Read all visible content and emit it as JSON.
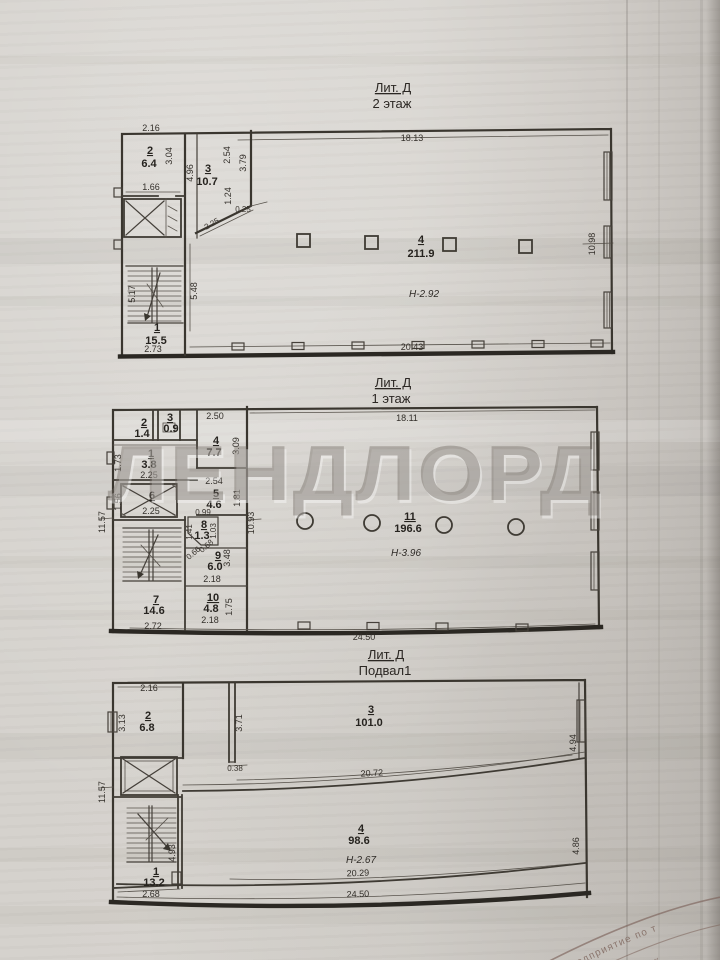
{
  "watermark": "ЛЕНДЛОРД",
  "floor2": {
    "title1": "Лит. Д",
    "title2": "2 этаж",
    "rooms": {
      "r1_num": "1",
      "r1_area": "15.5",
      "r2_num": "2",
      "r2_area": "6.4",
      "r3_num": "3",
      "r3_area": "10.7",
      "r4_num": "4",
      "r4_area": "211.9",
      "r4_height": "Н-2.92"
    },
    "dims": {
      "top": "18.13",
      "bottom": "20.43",
      "right_wall": "10.98",
      "r2_top": "2.16",
      "r2_side": "3.04",
      "r2_bottom": "1.66",
      "r3_side": "4.96",
      "r3_right": "2.54",
      "r3_far_right": "3.79",
      "r3_lower": "1.24",
      "wall_thick": "0.25",
      "diag": "2.25",
      "stairs_side": "5.17",
      "stairs_depth": "5.48",
      "r1_bottom": "2.73"
    }
  },
  "floor1": {
    "title1": "Лит. Д",
    "title2": "1 этаж",
    "rooms": {
      "r1_num": "1",
      "r1_area": "3.8",
      "r2_num": "2",
      "r2_area": "1.4",
      "r3_num": "3",
      "r3_area": "0.9",
      "r4_num": "4",
      "r4_area": "7.7",
      "r5_num": "5",
      "r5_area": "4.6",
      "r6_num": "6",
      "r7_num": "7",
      "r7_area": "14.6",
      "r8_num": "8",
      "r8_area": "1.3",
      "r9_num": "9",
      "r9_area": "6.0",
      "r10_num": "10",
      "r10_area": "4.8",
      "r11_num": "11",
      "r11_area": "196.6",
      "r11_height": "Н-3.96"
    },
    "dims": {
      "top": "18.11",
      "bottom": "24.50",
      "left_wall": "11.57",
      "hall_side": "10.93",
      "r4_top": "2.50",
      "r4_side": "3.09",
      "r1_side": "1.73",
      "r1_bottom": "2.25",
      "r5_top": "2.54",
      "r5_side": "1.81",
      "r6_side": "1.56",
      "r6_bottom": "2.25",
      "r8_top": "0.99",
      "r8_left": "1.41",
      "r8_right": "1.03",
      "r8_diag1": "0.66",
      "r8_diag2": "0.68",
      "r9_side": "3.48",
      "r9_bottom": "2.18",
      "r10_side": "1.75",
      "r10_bottom": "2.18",
      "r7_bottom": "2.72"
    }
  },
  "basement": {
    "title1": "Лит. Д",
    "title2": "Подвал1",
    "rooms": {
      "r1_num": "1",
      "r1_area": "13.2",
      "r2_num": "2",
      "r2_area": "6.8",
      "r3_num": "3",
      "r3_area": "101.0",
      "r4_num": "4",
      "r4_area": "98.6",
      "r4_height": "Н-2.67"
    },
    "dims": {
      "left_wall": "11.57",
      "r2_top": "2.16",
      "r2_side": "3.13",
      "partition": "3.71",
      "offset": "0.38",
      "r3_bottom": "20.72",
      "r3_side": "4.94",
      "r4_bottom": "20.29",
      "r4_side": "4.86",
      "bottom": "24.50",
      "r1_side": "4.93",
      "r1_bottom": "2.68"
    }
  },
  "stamp": {
    "arc_text1": "ное предприятие по т",
    "arc_text2": "оценки недвиж"
  }
}
